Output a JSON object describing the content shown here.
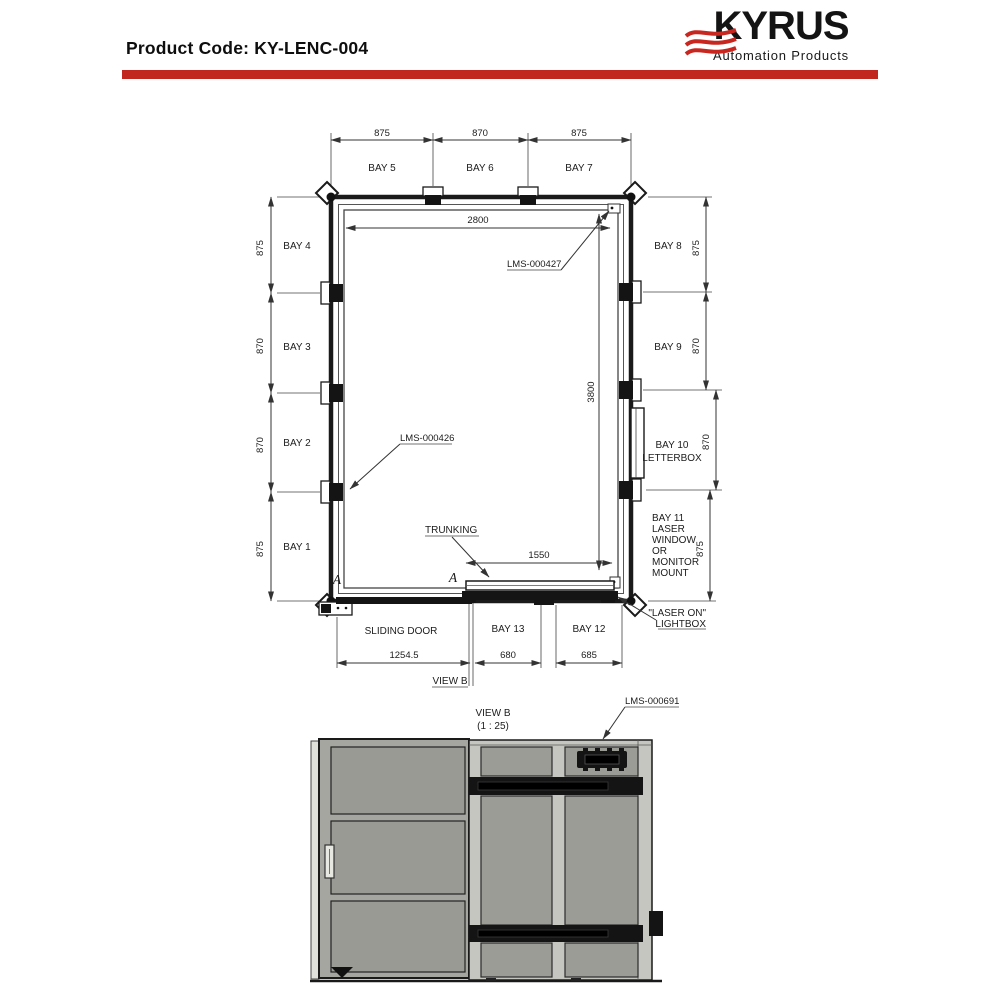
{
  "header": {
    "product_code": "Product Code: KY-LENC-004",
    "brand": "KYRUS",
    "tagline": "Automation Products",
    "accent_red": "#c1271f"
  },
  "plan_view": {
    "top_bays": [
      {
        "label": "BAY 5",
        "dim": "875"
      },
      {
        "label": "BAY 6",
        "dim": "870"
      },
      {
        "label": "BAY 7",
        "dim": "875"
      }
    ],
    "left_bays": [
      {
        "label": "BAY 4",
        "dim": "875"
      },
      {
        "label": "BAY 3",
        "dim": "870"
      },
      {
        "label": "BAY 2",
        "dim": "870"
      },
      {
        "label": "BAY 1",
        "dim": "875"
      }
    ],
    "right_bays": [
      {
        "label": "BAY 8",
        "dim": "875"
      },
      {
        "label": "BAY 9",
        "dim": "870"
      },
      {
        "label": "BAY 10",
        "label2": "LETTERBOX",
        "dim": "870"
      },
      {
        "label": "BAY 11",
        "dim": "875"
      }
    ],
    "bay11_lines": [
      "BAY 11",
      "LASER",
      "WINDOW",
      "OR",
      "MONITOR",
      "MOUNT"
    ],
    "inner_width_dim": "2800",
    "inner_height_dim": "3800",
    "part_label_left_wall": "LMS-000426",
    "part_label_top_right": "LMS-000427",
    "trunking_label": "TRUNKING",
    "trunking_dim": "1550",
    "section_marker": "A",
    "sliding_door_label": "SLIDING DOOR",
    "sliding_door_dim": "1254.5",
    "bottom_bays": [
      {
        "label": "BAY 13",
        "dim": "680"
      },
      {
        "label": "BAY 12",
        "dim": "685"
      }
    ],
    "view_ref_label": "VIEW B",
    "laser_on_line1": "\"LASER ON\"",
    "laser_on_line2": "LIGHTBOX"
  },
  "view_b": {
    "title": "VIEW B",
    "scale": "(1 : 25)",
    "part_label": "LMS-000691"
  }
}
